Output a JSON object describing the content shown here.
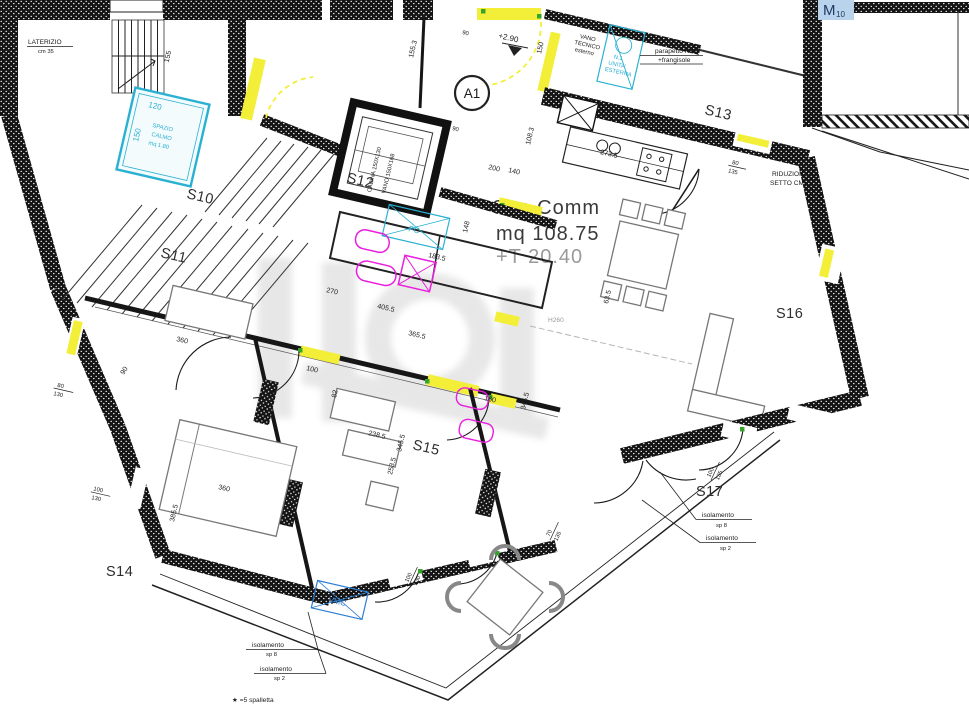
{
  "colors": {
    "door": "#f3ef39",
    "cyan": "#2ab1d2",
    "mag": "#e81fdf",
    "vmc": "#2d7dd2",
    "marker_bg": "#b9d3ec",
    "marker_fg": "#1d3a60",
    "green": "#37a32c",
    "ink": "#1b1b1b",
    "muted": "#9a9a9a",
    "wm": "#8a8a8a"
  },
  "rooms": {
    "s10": "S10",
    "s11": "S11",
    "s12": "S12",
    "s13": "S13",
    "s14": "S14",
    "s15": "S15",
    "s16": "S16",
    "s17": "S17"
  },
  "unit": {
    "badge": "A1",
    "marker": "M",
    "marker_sub": "10",
    "level": "+2.90",
    "height_note": "H260"
  },
  "area": {
    "line1": "Sup Comm",
    "line2": "mq 108.75",
    "line3": "+T 20.40"
  },
  "notes": {
    "laterizio1": "LATERIZIO",
    "laterizio2": "cm 35",
    "calmo1": "SPAZIO",
    "calmo2": "CALMO",
    "calmo3": "mq 1.80",
    "tecnico1": "VANO",
    "tecnico2": "TECNICO",
    "tecnico3": "esterno",
    "unita1": "N.1",
    "unita2": "UNITA'",
    "unita3": "ESTERNA",
    "parapetto1": "parapetto H110",
    "parapetto2": "+frangisole",
    "riduzione1": "RIDUZIONE",
    "riduzione2": "SETTO CM20",
    "lift1": "CABINA 150X130",
    "lift2": "VANO 150X168",
    "vmc": "VMC",
    "pc": "PC",
    "iso_a1": "isolamento",
    "iso_a2": "sp 8",
    "iso_b1": "isolamento",
    "iso_b2": "sp 2",
    "legend": "★ =5 spalletta"
  },
  "dims": {
    "d155": "155",
    "d1553": "155.3",
    "d150": "150",
    "d1083": "108.3",
    "d200": "200",
    "d140": "140",
    "d2735": "273.5",
    "d80": "80",
    "d135": "135",
    "d270": "270",
    "d4055": "405.5",
    "d3655": "365.5",
    "d1835": "183.5",
    "d148": "148",
    "d160": "160",
    "d3455": "345.5",
    "d100": "100",
    "d82": "82",
    "d360": "360",
    "d3855": "385.5",
    "d130": "130",
    "d2385": "238.5",
    "d2535": "253.5",
    "d70": "70",
    "d230": "230",
    "d635": "63.5",
    "d120": "120",
    "sc150": "150",
    "d90": "90",
    "door_tag": "90"
  }
}
